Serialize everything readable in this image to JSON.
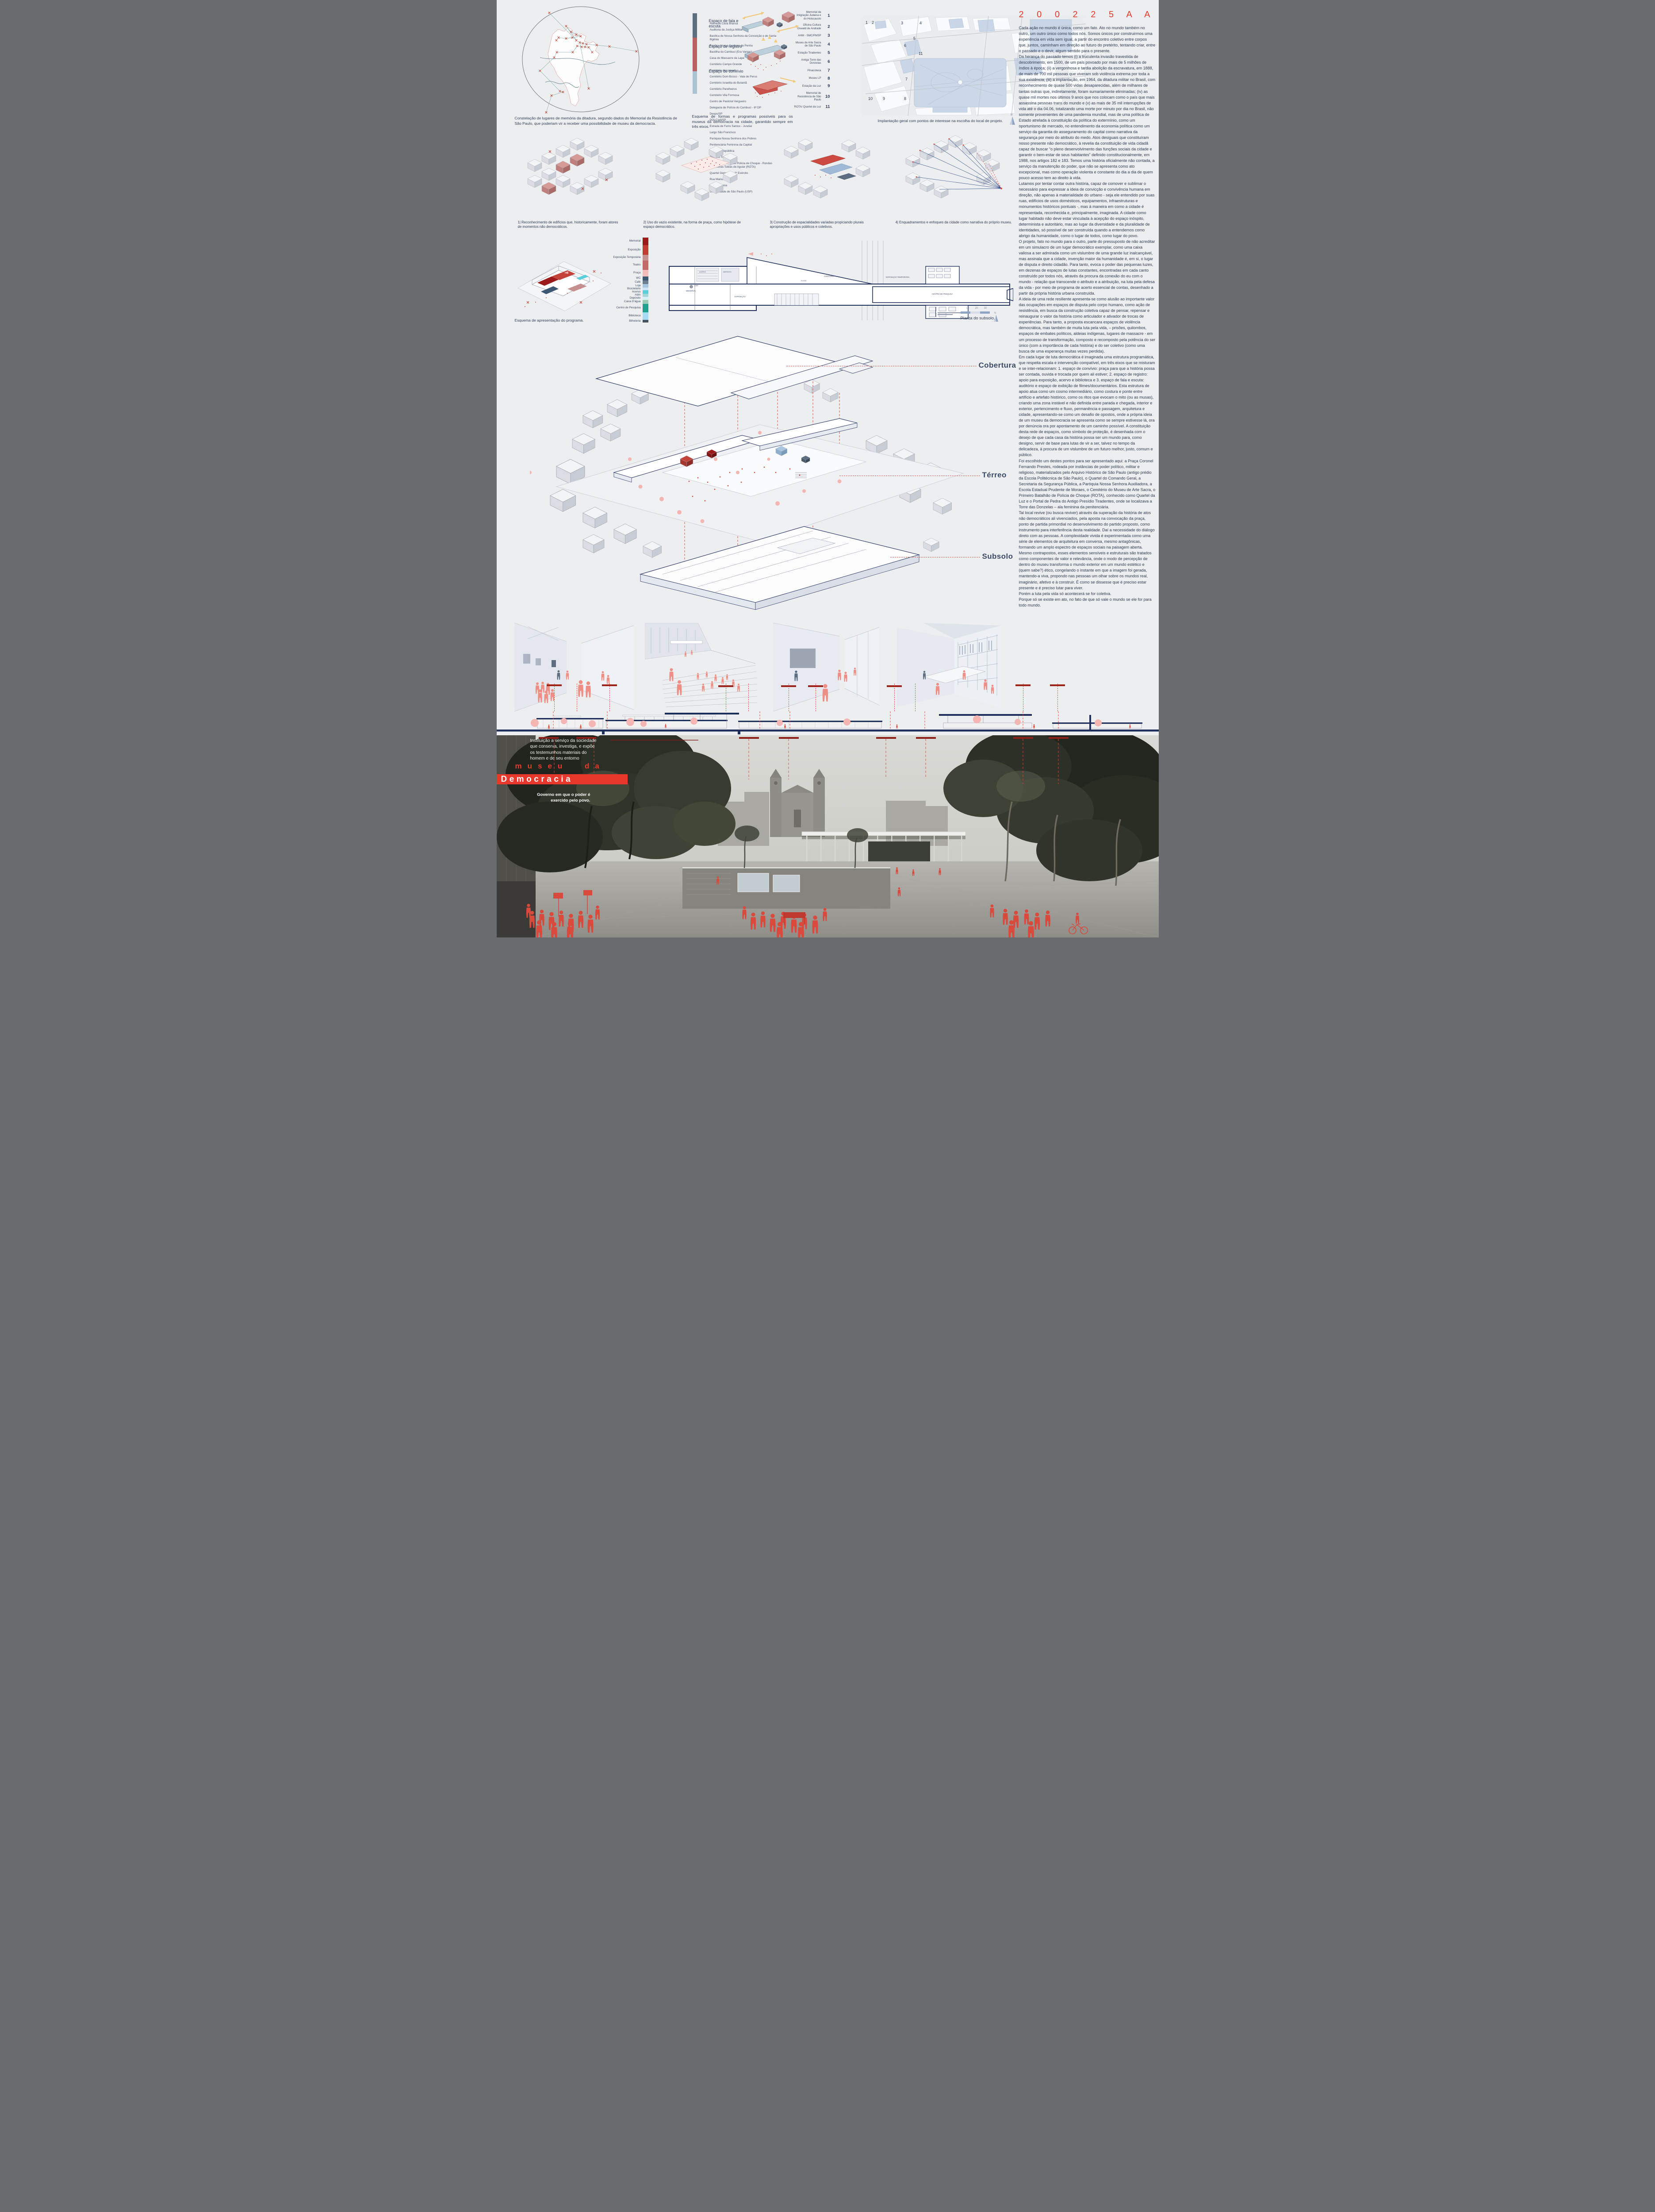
{
  "statement": {
    "code": "2 0 0 2 2 5 A A",
    "paragraphs": [
      "Cada ação no mundo é única, como um fato. Ato no mundo também no outro, um outro único como todos nós. Somos únicos por construirmos uma experiência em vida sem igual, a partir do encontro coletivo entre corpos que, juntos, caminham em direção ao futuro do pretérito, tentando criar, entre o passado e o devir, algum sentido para o presente.",
      "Da herança do passado temos (i) a truculenta invasão travestida de descobrimento, em 1500, de um país povoado por mais de 5 milhões de índios à época; (ii) a vergonhosa e tardia abolição da escravatura, em 1888, de mais de 700 mil pessoas que viveram sob violência extrema por toda a sua existência; (iii) a implantação, em 1964, da ditadura militar no Brasil, com reconhecimento de quase 500 vidas desaparecidas, além de milhares de tantas outras que, indiretamente, foram sumariamente eliminadas; (iv) as quase mil mortes nos últimos 9 anos que nos colocam como o país que mais assassina pessoas trans do mundo e (v) as mais de 35 mil interrupções de vida até o dia 04.06, totalizando uma morte por minuto por dia no Brasil, não somente provenientes de uma pandemia mundial, mas de uma política de Estado atrelada à constituição da política do extermínio, como um oportunismo de mercado, no entendimento da economia política como um serviço da garantia do asseguramento do capital como narrativa da segurança por meio do atributo do medo. Atos desiguais que constituíram nosso presente não democrático, à revelia da constituição de vida cidadã capaz de buscar “o pleno desenvolvimento das funções sociais da cidade e garantir o bem-estar de seus habitantes” definido constitucionalmente, em 1988, nos artigos 182 e 183. Temos uma história oficialmente não contada, a serviço da manutenção do poder, que não se apresenta como ato excepcional, mas como operação violenta e constante do dia a dia de quem pouco acesso tem ao direito à vida.",
      "Lutamos por tentar contar outra história, capaz de comover e sublimar o necessário para expressar a ideia de convicção e convivência humana em direção, não apenas à materialidade do urbano - seja ele entendido por suas ruas, edifícios de usos domésticos, equipamentos, infraestruturas e monumentos históricos pontuais -, mas à maneira em como a cidade é representada, reconhecida e, principalmente, imaginada. A cidade como lugar habitado não deve estar vinculada à acepção do espaço inóspito, determinista e autoritário, mas ao lugar da diversidade e da pluralidade de identidades, só possível de ser construída quando a entendemos como abrigo da humanidade, como o lugar de todos, como lugar do povo.",
      "O projeto, fato no mundo para o outro, parte do pressuposto de não acreditar em um simulacro de um lugar democrático exemplar, como uma caixa valiosa a ser admirada como um vislumbre de uma grande luz inalcançável, mas assinala que a cidade, invenção maior da humanidade é, em si, o lugar de disputa e direito cidadão. Para tanto, evoca o poder das pequenas luzes, em dezenas de espaços de lutas constantes, encontradas em cada canto construído por todos nós, através da procura da conexão do eu com o mundo - relação que transcende o atributo e a atribuição, na luta pela defesa da vida - por meio de programa de acerto essencial de contas, desenhado a partir da própria história urbana construída.",
      "A ideia de uma rede resiliente apresenta-se como alusão ao importante valor das ocupações em espaços de disputa pelo corpo humano, como ação de resistência, em busca da construção coletiva capaz de pensar, repensar e reinaugurar o valor da história como articulador e ativador de trocas de experiências. Para tanto, a proposta escancara espaços de violência democrática, mas também de muita luta pela vida, – prisões, quilombos, espaços de embates políticos, aldeias indígenas, lugares de massacre - em um processo de transformação, composto e recomposto pela potência do ser único (com a importância de cada história) e do ser coletivo (como uma busca de uma esperança muitas vezes perdida).",
      "Em cada lugar de luta democrática é imaginada uma estrutura programática, que respeita escala e intervenção compatível, em três eixos que se misturam e se inter-relacionam: 1. espaço de convívio: praça para que a história possa ser contada, ouvida e trocada por quem ali estiver; 2. espaço de registro: apoio para exposição, acervo e biblioteca e 3. espaço de fala e escuta: auditório e espaço de exibição de filmes/documentários. Esta estrutura de apoio atua como um cosmo intermediário, como costura e ponte entre artifício e artefato histórico, como os ritos que evocam o mito (ou as musas), criando uma zona instável e não definida entre parada e chegada, interior e exterior, pertencimento e fluxo, permanência e passagem, arquitetura e cidade, apresentando-se como um desafio de opostos, onde a própria ideia de um museu da democracia se apresenta como se sempre estivesse lá, ora por denúncia ora por apontamento de um caminho possível. A constituição desta rede de espaços, como símbolo de proteção, é desenhada com o desejo de que cada casa da história possa ser um mundo para, como designo, servir de base para lutas de vir a ser, talvez no tempo da delicadeza, à procura de um vislumbre de um futuro melhor, justo, comum e público.",
      "Foi escolhido um destes pontos para ser apresentado aqui: a Praça Coronel Fernando Prestes, rodeada por instâncias de poder político, militar e religioso, materializados pelo Arquivo Histórico de São Paulo (antigo prédio da Escola Politécnica de São Paulo), o Quartel do Comando Geral, a Secretaria da Segurança Pública, a Paróquia Nossa Senhora Auxiliadora, a Escola Estadual Prudente de Moraes, o Cemitério do Museu de Arte Sacra, o Primeiro Batalhão de Polícia de Choque (ROTA), conhecido como Quartel da Luz e o Portal de Pedra do Antigo Presídio Tiradentes, onde se localizava a Torre das Donzelas – ala feminina da penitenciária.",
      "Tal local revive (ou busca reviver) através da superação da história de atos não democráticos ali vivenciados, pela aposta na convocação da praça, ponto de partida primordial no desenvolvimento do partido proposto, como instrumento para interferência desta realidade. Daí a necessidade do diálogo direto com as pessoas. A complexidade vivida é experimentada como uma série de elementos de arquitetura em conversa, mesmo antagônicas, formando um amplo espectro de espaços sociais na paisagem aberta. Mesmo contrapostos, esses elementos sensíveis e estruturais são tratados como componentes de valor e relevância, onde o modo de percepção de dentro do museu transforma o mundo exterior em um mundo estético e (quem sabe?) ético, congelando o instante em que a imagem foi gerada, mantendo-a viva, propondo nas pessoas um olhar sobre os mundos real, imaginário, afetivo e à construir. É como se dissesse que é preciso estar presente e é preciso lutar para viver.",
      "Porém a luta pela vida só acontecerá se for coletiva.",
      "Porque só se existe em ato, no fato de que só vale o mundo se ele for para todo mundo."
    ]
  },
  "constellation": {
    "caption": "Constelação de lugares de memória da ditadura, segundo dados do Memorial da Resistência de São Paulo, que poderiam vir a receber uma possibilidade de museu da democracia.",
    "places": [
      "Alameda Casa Branca",
      "Auditoria da Justiça Militar",
      "Basílica de Nossa Senhora da Conceição e de Santa Ifigênia",
      "Basílica Nossa Senhora da Penha",
      "Bastilha do Cambuci (Era Vargas)",
      "Casa do Massacre da Lapa",
      "Cemitério Campo Grande",
      "Cemitério do Lajeado",
      "Cemitério Dom Bosco - Vala de Perus",
      "Cemitério Israelita do Butantã",
      "Cemitério Parelheiros",
      "Cemitério Vila Formosa",
      "Centro de Pastoral Vergueiro",
      "Delegacia de Polícia do Cambuci - 6ª DP",
      "Deops/SP",
      "DOI-Codi/SP",
      "Estrada de Ferro Santos - Jundiaí",
      "Largo São Francisco",
      "Paróquia Nossa Senhora dos Pobres",
      "Penitenciária Feminina da Capital",
      "Praça da República",
      "Presídio Tiradentes",
      "Primeiro Batalhão de Polícia de Choque - Rondas Ostensivas Tobias de Aguiar (ROTA)",
      "Quartel General do 2º Exército",
      "Rua Maria Antônia",
      "Teatro Oficina",
      "Universidade de São Paulo (USP)"
    ]
  },
  "program_scheme": {
    "axes": [
      "Espaço de fala e escuta",
      "Espaço de registro",
      "Espaço de convívio"
    ],
    "caption": "Esquema de formas e programas possíveis para os museus da democracia na cidade, garantido sempre em três eixos."
  },
  "poi": {
    "items": [
      {
        "num": "1",
        "label": "Memorial da Imigração Judaica e do Holocausto"
      },
      {
        "num": "2",
        "label": "Oficina Cultura Oswald de Andrade"
      },
      {
        "num": "3",
        "label": "AHM - SMC/PMSP"
      },
      {
        "num": "4",
        "label": "Museu de Arte Sacra de São Paulo"
      },
      {
        "num": "5",
        "label": "Estação Tiradentes"
      },
      {
        "num": "6",
        "label": "Antiga Torre das Donzelas"
      },
      {
        "num": "7",
        "label": "Pinacoteca"
      },
      {
        "num": "8",
        "label": "Museu LP"
      },
      {
        "num": "9",
        "label": "Estação da Luz"
      },
      {
        "num": "10",
        "label": "Memorial de Resistência de São Paulo"
      },
      {
        "num": "11",
        "label": "ROTA/ Quartel da Luz"
      }
    ]
  },
  "site_plan": {
    "caption": "Implantação geral com pontos de interesse na escolha do local de projeto.",
    "north": "N",
    "markers": [
      "1",
      "2",
      "3",
      "4",
      "5",
      "6",
      "7",
      "8",
      "9",
      "10",
      "11"
    ]
  },
  "analysis": {
    "captions": [
      "1| Reconhecimento de edifícios que, historicamente, foram atores de momentos não democráticos.",
      "2| Uso do vazio existente, na forma de praça, como hipótese de espaço democrático.",
      "3| Construção de espacialidades variadas propiciando plurais apropriações e usos públicos e coletivos.",
      "4| Enquadramentos e enfoques da cidade como narrativa do próprio museu."
    ]
  },
  "program_axon": {
    "caption": "Esquema de apresentação do programa."
  },
  "legend": {
    "items": [
      {
        "label": "Memorial",
        "color": "#9c1a1a"
      },
      {
        "label": "Exposição",
        "color": "#c33b32"
      },
      {
        "label": "Exposição Temporária",
        "color": "#c59090"
      },
      {
        "label": "Teatro",
        "color": "#c26a66"
      },
      {
        "label": "Praça",
        "color": "#f2bcb8"
      },
      {
        "label": "WC",
        "color": "#3d5872"
      },
      {
        "label": "Café",
        "color": "#6e8090"
      },
      {
        "label": "Loja",
        "color": "#a9c6e0"
      },
      {
        "label": "Bicicletário",
        "color": "#cfe4f4"
      },
      {
        "label": "Acervo",
        "color": "#59cfda"
      },
      {
        "label": "Adm",
        "color": "#a2d8d8"
      },
      {
        "label": "Depósito",
        "color": "#d6f0f5"
      },
      {
        "label": "Caixa D'água",
        "color": "#9ccab5"
      },
      {
        "label": "Centro de Pesquisa",
        "color": "#1ea28e"
      },
      {
        "label": "Biblioteca",
        "color": "#a8dcf2"
      },
      {
        "label": "Bilheteria",
        "color": "#46525e"
      }
    ]
  },
  "subsoil": {
    "caption": "Planta do subsolo.",
    "scale_ticks": [
      "10",
      "20",
      "30"
    ],
    "north": "N",
    "level": "-3.00",
    "room_labels": [
      "MEMORIAL",
      "EXPOSIÇÃO",
      "ACERVO",
      "DEPÓSITO",
      "FOYER",
      "AUDITÓRIO",
      "EXPOSIÇÃO TEMPORÁRIA",
      "CENTRO DE PESQUISA"
    ]
  },
  "axon": {
    "levels": [
      "Cobertura",
      "Térreo",
      "Subsolo"
    ]
  },
  "title_block": {
    "definition": "Instituição a serviço da sociedade que conserva, investiga, e expõe os testemunhos materiais do homem e de seu entorno",
    "title_top": "museu da",
    "title_main": "Democracia",
    "subtitle": "Governo em que o poder é exercido pelo povo."
  },
  "colors": {
    "accent_red": "#e8372b",
    "navy_text": "#2c3a54",
    "drawing_blue": "#1e2f5c",
    "people_salmon": "#ef8e85",
    "people_red": "#d9493c"
  }
}
